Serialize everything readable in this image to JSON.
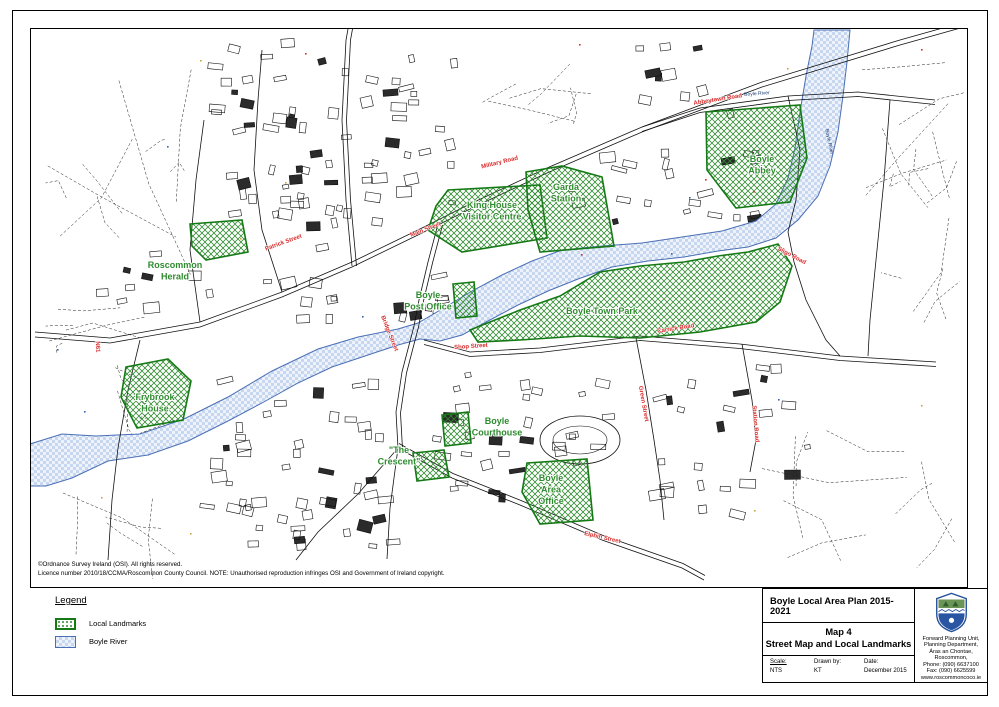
{
  "legend": {
    "title": "Legend",
    "items": [
      {
        "label": "Local Landmarks",
        "swatch": "green-hatched-area"
      },
      {
        "label": "Boyle River",
        "swatch": "blue-checkered-area"
      }
    ]
  },
  "copyright": {
    "line1": "©Ordnance Survey Ireland (OSI). All rights reserved.",
    "line2": "Licence number 2010/18/CCMA/Roscommon County Council. NOTE: Unauthorised reproduction infringes OSI and Government of Ireland copyright."
  },
  "title_block": {
    "plan_title": "Boyle Local Area Plan 2015-2021",
    "map_number": "Map 4",
    "map_title": "Street Map and Local Landmarks",
    "scale_label": "Scale:",
    "scale_value": "NTS",
    "drawn_label": "Drawn by:",
    "drawn_value": "KT",
    "date_label": "Date:",
    "date_value": "December 2015",
    "department": {
      "lines": [
        "Forward Planning Unit,",
        "Planning Department,",
        "Áras an Chontae,",
        "Roscommon,",
        "Phone: (090) 6637100",
        "Fax: (090) 6625599",
        "www.roscommoncoco.ie"
      ]
    }
  },
  "map": {
    "landmark_labels": [
      {
        "lines": [
          "Roscommon",
          "Herald"
        ],
        "x": 175,
        "y": 268
      },
      {
        "lines": [
          "King House",
          "Visitor Centre"
        ],
        "x": 492,
        "y": 208
      },
      {
        "lines": [
          "Garda",
          "Station"
        ],
        "x": 566,
        "y": 190
      },
      {
        "lines": [
          "Boyle",
          "Abbey"
        ],
        "x": 762,
        "y": 162
      },
      {
        "lines": [
          "Boyle Town Park"
        ],
        "x": 602,
        "y": 314
      },
      {
        "lines": [
          "Boyle",
          "Post Office"
        ],
        "x": 428,
        "y": 298
      },
      {
        "lines": [
          "Frybrook",
          "House"
        ],
        "x": 155,
        "y": 400
      },
      {
        "lines": [
          "Boyle",
          "Courthouse"
        ],
        "x": 497,
        "y": 424
      },
      {
        "lines": [
          "\"The",
          "Crescent\""
        ],
        "x": 399,
        "y": 453
      },
      {
        "lines": [
          "Boyle",
          "Area",
          "Office"
        ],
        "x": 551,
        "y": 481
      }
    ],
    "street_labels": [
      {
        "text": "Military Road",
        "x": 500,
        "y": 164,
        "rot": -14
      },
      {
        "text": "Abbeytown Road",
        "x": 718,
        "y": 101,
        "rot": -9
      },
      {
        "text": "Patrick Street",
        "x": 284,
        "y": 244,
        "rot": -20
      },
      {
        "text": "Main Street",
        "x": 426,
        "y": 231,
        "rot": -21
      },
      {
        "text": "Bridge Street",
        "x": 388,
        "y": 334,
        "rot": 68
      },
      {
        "text": "Shop Street",
        "x": 471,
        "y": 348,
        "rot": -4
      },
      {
        "text": "Carrick Road",
        "x": 676,
        "y": 330,
        "rot": -9
      },
      {
        "text": "Sligo Road",
        "x": 791,
        "y": 257,
        "rot": 28
      },
      {
        "text": "Elphin Street",
        "x": 602,
        "y": 539,
        "rot": 13
      },
      {
        "text": "Green Street",
        "x": 642,
        "y": 404,
        "rot": 80
      },
      {
        "text": "Station Road",
        "x": 754,
        "y": 424,
        "rot": 85
      },
      {
        "text": "N61",
        "x": 96,
        "y": 347,
        "rot": 87
      }
    ],
    "river_labels": [
      {
        "text": "Boyle River",
        "x": 757,
        "y": 95,
        "rot": -4
      },
      {
        "text": "Boyle River",
        "x": 828,
        "y": 142,
        "rot": 78
      }
    ]
  }
}
